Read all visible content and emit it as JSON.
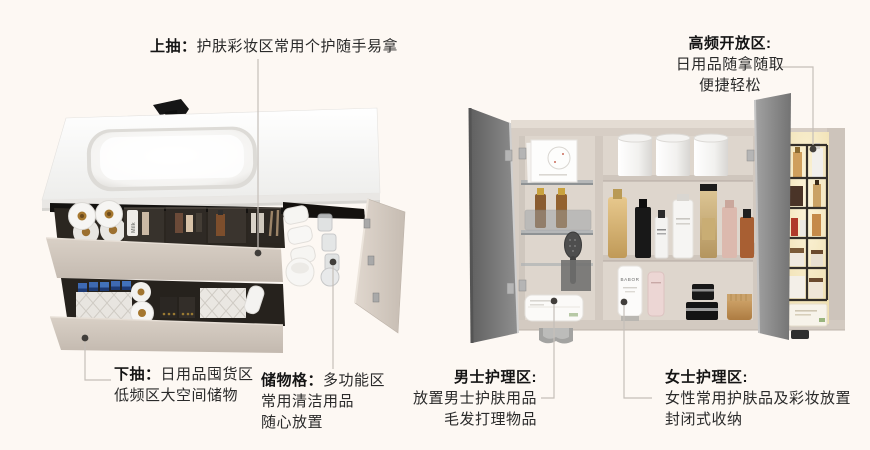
{
  "canvas": {
    "width": 870,
    "height": 450,
    "background": "#fdf8f3"
  },
  "palette": {
    "text": "#2a2a2a",
    "title_text": "#141414",
    "leader_line": "#c5bfb9",
    "leader_dot": "#413e3b",
    "cabinet_beige": "#d7cec5",
    "drawer_front": "#ccc2b8",
    "counter_white": "#fbfbfa",
    "mirror_door_gray": "#828282",
    "interior_dark": "#29251f",
    "niche_glow": "#f8edcd",
    "blue_caps": "#3f6cb3",
    "amber_core": "#a5772f"
  },
  "callouts": {
    "upper_drawer": {
      "title": "上抽：",
      "body": "护肤彩妆区常用个护随手易拿"
    },
    "open_zone": {
      "title": "高频开放区:",
      "lines": [
        "日用品随拿随取",
        "便捷轻松"
      ]
    },
    "lower_drawer": {
      "title": "下抽：",
      "body": "日用品囤货区",
      "line2": "低频区大空间储物"
    },
    "storage_grid": {
      "title": "储物格：",
      "body": "多功能区",
      "lines": [
        "常用清洁用品",
        "随心放置"
      ]
    },
    "mens_zone": {
      "title": "男士护理区:",
      "lines": [
        "放置男士护肤用品",
        "毛发打理物品"
      ]
    },
    "womens_zone": {
      "title": "女士护理区:",
      "lines": [
        "女性常用护肤品及彩妆放置",
        "封闭式收纳"
      ]
    }
  },
  "product_labels": {
    "milk_bottle": "Milk",
    "babor_tube": "BABOR"
  }
}
